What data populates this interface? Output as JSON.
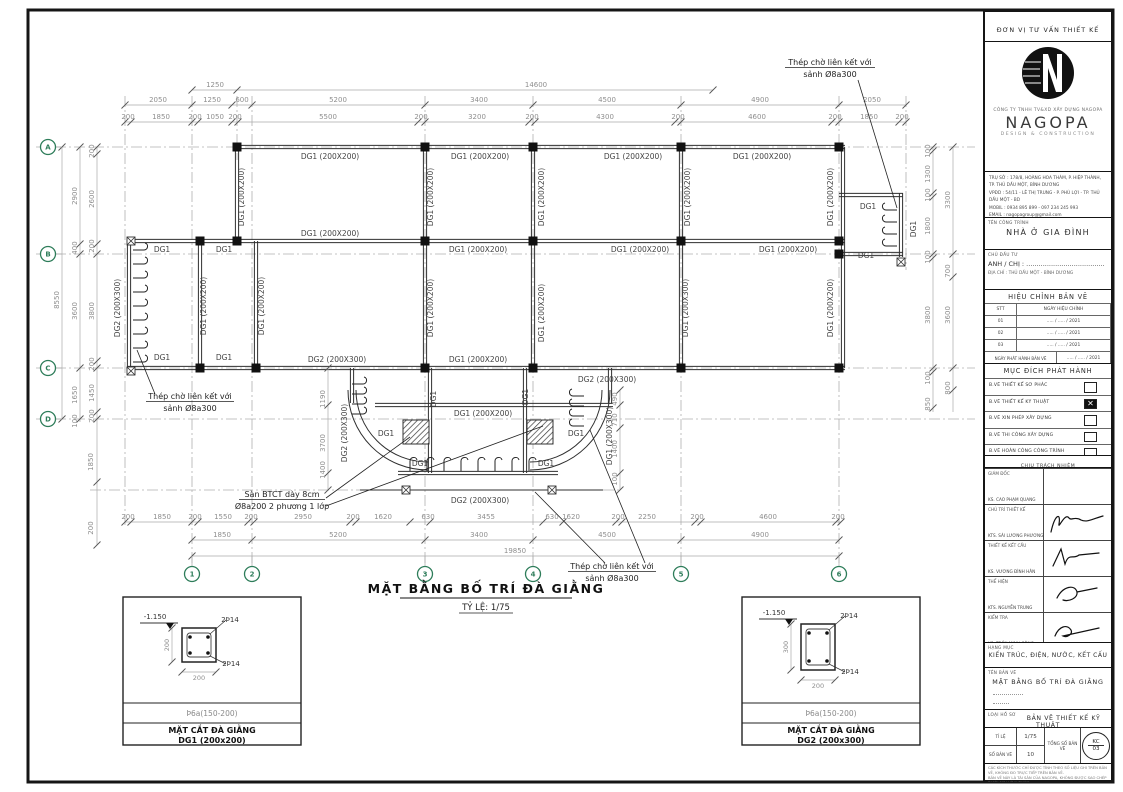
{
  "colors": {
    "line": "#2f2f2f",
    "dim": "#8f8f8f",
    "grid": "#b0b0b0",
    "green": "#2e7d5a",
    "label": "#444444"
  },
  "plan": {
    "title": "MẶT BẰNG BỐ TRÍ ĐÀ GIẰNG",
    "scale": "TỶ LỆ: 1/75",
    "beams": {
      "dg1": "DG1",
      "dg1_200": "DG1 (200X200)",
      "dg1_300": "DG1 (200X300)",
      "dg2_300": "DG2 (200X300)"
    },
    "annotations": {
      "hook_l1": "Thép chờ liên kết với",
      "hook_l2": "sảnh Ø8a300",
      "slab_l1": "Sàn BTCT dày 8cm",
      "slab_l2": "Ø8a200 2 phương 1 lớp"
    },
    "grid_rows": [
      "A",
      "B",
      "C",
      "D"
    ],
    "grid_cols": [
      "1",
      "2",
      "3",
      "4",
      "5",
      "6"
    ],
    "dims": {
      "top1": [
        "1250",
        "14600"
      ],
      "top2": [
        "2050",
        "1250",
        "600",
        "5200",
        "3400",
        "4500",
        "4900",
        "2050"
      ],
      "top3": [
        "200",
        "1850",
        "200",
        "1050",
        "200",
        "5500",
        "200",
        "3200",
        "200",
        "4300",
        "200",
        "4600",
        "200",
        "1850",
        "200"
      ],
      "bottom1": [
        "200",
        "1850",
        "200",
        "1550",
        "200",
        "2950",
        "200",
        "1620",
        "630",
        "3455",
        "630",
        "1620",
        "200",
        "2250",
        "200",
        "4600",
        "200"
      ],
      "bottom2": [
        "1850",
        "5200",
        "3400",
        "4500",
        "4900"
      ],
      "bottom_total": "19850",
      "left_total": "8550",
      "left_mid": [
        "2900",
        "400",
        "3600",
        "1650",
        "100"
      ],
      "left_inner": [
        "200",
        "2600",
        "200",
        "3800",
        "200",
        "1450",
        "200"
      ],
      "left_below": [
        "1850",
        "200"
      ],
      "right_inner": [
        "100",
        "1300",
        "100",
        "1800",
        "100",
        "3800",
        "100",
        "850"
      ],
      "right_outer": [
        "3300",
        "700",
        "3600",
        "800"
      ],
      "porch_left": [
        "1190",
        "3700",
        "1400"
      ],
      "porch_right": [
        "490",
        "710",
        "1400",
        "100"
      ]
    }
  },
  "details": [
    {
      "level": "-1.150",
      "top_bars": "2Þ14",
      "bottom_bars": "2Þ14",
      "width_dim": "200",
      "height_dim": "200",
      "stirrup": "Þ6a(150-200)",
      "title": "MẶT CẮT ĐÀ GIẰNG",
      "subtitle": "DG1 (200x200)"
    },
    {
      "level": "-1.150",
      "top_bars": "2Þ14",
      "bottom_bars": "2Þ14",
      "width_dim": "200",
      "height_dim": "300",
      "stirrup": "Þ6a(150-200)",
      "title": "MẶT CẮT ĐÀ GIẰNG",
      "subtitle": "DG2 (200x300)"
    }
  ],
  "title_block": {
    "header": "ĐƠN VỊ TƯ VẤN THIẾT KẾ",
    "company_small": "CÔNG TY TNHH TV&XD XÂY DỰNG NAGOPA",
    "brand": "NAGOPA",
    "brand_sub": "DESIGN & CONSTRUCTION",
    "contact_lines": [
      "TRỤ SỞ : 178/8, HOÀNG HOA THÁM, P. HIỆP THÀNH,",
      "TP. THỦ DẦU MỘT, BÌNH DƯƠNG",
      "VPĐD : 54/11 - LÊ THỊ TRUNG - P. PHÚ LỢI - TP. THỦ DẦU MỘT - BD",
      "MOBIL : 0934 895 899  -  097 234 245 993",
      "EMAIL : nagopagroup@gmail.com",
      "WEBSITE : WWW.THIETKENHANAGOPA.COM - WWW.NAGOPA.COM"
    ],
    "project_label": "TÊN CÔNG TRÌNH",
    "project_name": "NHÀ Ở GIA ĐÌNH",
    "client_label": "CHỦ ĐẦU TƯ",
    "client_name": "ANH / CHỊ : ......................................",
    "client_address": "ĐỊA CHỈ : THỦ DẦU MỘT - BÌNH DƯƠNG",
    "revision": {
      "title": "HIỆU CHỈNH BẢN VẼ",
      "col1": "STT",
      "col2": "NGÀY HIỆU CHỈNH",
      "rows": [
        {
          "no": "01",
          "date": "..... / ..... / 2021"
        },
        {
          "no": "02",
          "date": "..... / ..... / 2021"
        },
        {
          "no": "03",
          "date": "..... / ..... / 2021"
        }
      ],
      "issue_label": "NGÀY PHÁT HÀNH BẢN VẼ",
      "issue_value": "..... / ..... / 2021"
    },
    "purpose": {
      "title": "MỤC ĐÍCH PHÁT HÀNH",
      "items": [
        {
          "label": "B.VẼ THIẾT KẾ SƠ PHÁC",
          "checked": false
        },
        {
          "label": "B.VẼ THIẾT KẾ KỸ THUẬT",
          "checked": true
        },
        {
          "label": "B.VẼ XIN PHÉP XÂY DỰNG",
          "checked": false
        },
        {
          "label": "B.VẼ THI CÔNG XÂY DỰNG",
          "checked": false
        },
        {
          "label": "B.VẼ HOÀN CÔNG CÔNG TRÌNH",
          "checked": false
        }
      ],
      "check_mark": "✕"
    },
    "responsibility_title": "CHỊU TRÁCH NHIỆM",
    "signers": [
      {
        "role": "GIÁM ĐỐC",
        "name": "KS. CAO PHẠM QUANG"
      },
      {
        "role": "CHỦ TRÌ THIẾT KẾ",
        "name": "KTS. SÁI LƯƠNG PHƯƠNG"
      },
      {
        "role": "THIẾT KẾ KẾT CẤU",
        "name": "KS. VƯƠNG ĐÌNH HÂN"
      },
      {
        "role": "THỂ HIỆN",
        "name": "KTS. NGUYỄN TRUNG"
      },
      {
        "role": "KIỂM TRA",
        "name": "KS. TRẦN MINH CÔNG"
      }
    ],
    "category_label": "HẠNG MỤC",
    "category": "KIẾN TRÚC, ĐIỆN, NƯỚC, KẾT CẤU",
    "drawing_name_label": "TÊN BẢN VẼ",
    "drawing_name": "MẶT BẰNG BỐ TRÍ ĐÀ GIẰNG",
    "doc_type_label": "LOẠI HỒ SƠ",
    "doc_type": "BẢN VẼ THIẾT KẾ KỸ THUẬT",
    "scale_label": "TỈ LỆ",
    "scale_value": "1/75",
    "sheet_no_label": "SỐ BẢN VẼ",
    "sheet_no_value": "10",
    "total_label": "TỔNG SỐ BẢN VẼ",
    "sheet_code": "KC",
    "sheet_code_num": "03",
    "notes": [
      "CÁC KÍCH THƯỚC CHỈ ĐƯỢC TÍNH THEO SỐ LIỆU GHI TRÊN BẢN VẼ, KHÔNG ĐO TRỰC TIẾP TRÊN BẢN VẼ.",
      "BẢN VẼ NÀY LÀ TÀI SẢN CỦA NAGOPA, KHÔNG ĐƯỢC SAO CHÉP DƯỚI MỌI HÌNH THỨC",
      "KHI CHƯA CÓ SỰ ĐỒNG Ý CỦA ĐƠN VỊ THIẾT KẾ.",
      "MỌI CHI TIẾT LIÊN QUAN VUI LÒNG LIÊN HỆ VĂN PHÒNG THIẾT KẾ."
    ]
  }
}
